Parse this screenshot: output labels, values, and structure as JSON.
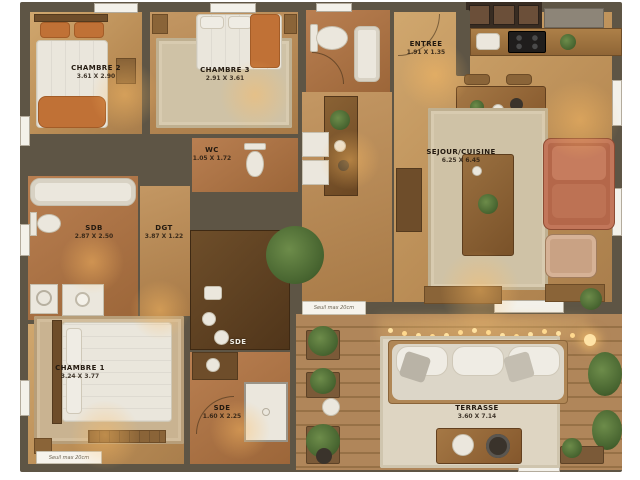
{
  "plan_type": "apartment-floor-plan",
  "rooms": {
    "chambre2": {
      "label": "CHAMBRE 2",
      "dims": "3.61 X 2.90"
    },
    "chambre3": {
      "label": "CHAMBRE 3",
      "dims": "2.91 X 3.61"
    },
    "entree": {
      "label": "ENTREE",
      "dims": "1.91 X 1.35"
    },
    "wc": {
      "label": "WC",
      "dims": "1.05 X 1.72"
    },
    "sejour_cuisine": {
      "label": "SEJOUR/CUISINE",
      "dims": "6.25 X 6.45"
    },
    "sdb": {
      "label": "SDB",
      "dims": "2.87 X 2.50"
    },
    "dgt": {
      "label": "DGT",
      "dims": "3.87 X 1.22"
    },
    "chambre1": {
      "label": "CHAMBRE 1",
      "dims": "3.24 X 3.77"
    },
    "sde_upper": {
      "label": "SDE",
      "dims": ""
    },
    "sde": {
      "label": "SDE",
      "dims": "1.60 X 2.25"
    },
    "terrasse": {
      "label": "TERRASSE",
      "dims": "3.60 X 7.14"
    }
  },
  "notes": {
    "seuil_terrace": "Seuil max 20cm",
    "seuil_bottom": "Seuil max 20cm"
  },
  "colors": {
    "wall": "#5e5545",
    "wood_floor": "#b98c55",
    "tile_floor": "#a96f44",
    "rug": "#cfc2a6",
    "deck": "#a87e50",
    "sofa_terracotta": "#b4674a",
    "bed_linen": "#eae6dc",
    "accent_throw": "#c07136",
    "plant_green": "#46632f",
    "light_warm": "#ffd98f"
  }
}
